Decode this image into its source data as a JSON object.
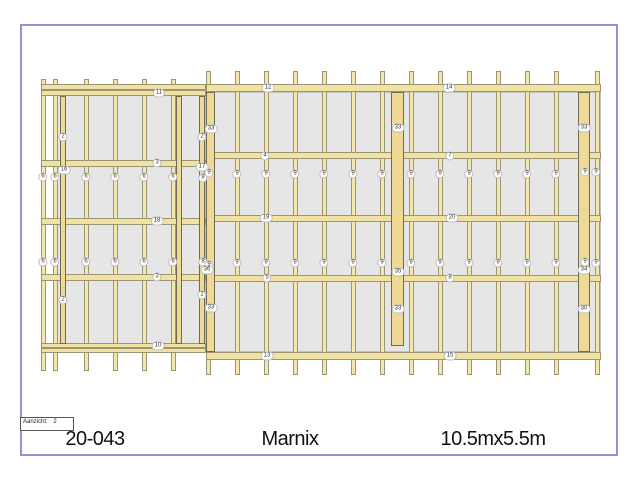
{
  "sheet": {
    "x": 20,
    "y": 24,
    "w": 598,
    "h": 432,
    "border_color": "#9193ce"
  },
  "titleblock": {
    "code": "20-043",
    "name": "Marnix",
    "size": "10.5mx5.5m"
  },
  "viewbox": {
    "label": "Aanzicht:",
    "value": "2"
  },
  "colors": {
    "wood": "#f4e7ae",
    "rail": "#f2e2a2",
    "post": "#eeda96",
    "wood_border": "#9b9577",
    "post_border": "#6f6a55",
    "panel": "#e6e6e6",
    "panel_border": "#c3c3c3",
    "sheet_border": "#9193ce",
    "label_text": "#333333"
  },
  "drawing": {
    "panels": [
      {
        "x": 57,
        "y": 92,
        "w": 149,
        "h": 252
      },
      {
        "x": 206,
        "y": 92,
        "w": 395,
        "h": 260
      }
    ],
    "studs": [
      {
        "x": 41,
        "y1": 79,
        "y2": 371
      },
      {
        "x": 53,
        "y1": 79,
        "y2": 371
      },
      {
        "x": 84,
        "y1": 79,
        "y2": 371
      },
      {
        "x": 113,
        "y1": 79,
        "y2": 371
      },
      {
        "x": 142,
        "y1": 79,
        "y2": 371
      },
      {
        "x": 171,
        "y1": 79,
        "y2": 371
      },
      {
        "x": 206,
        "y1": 71,
        "y2": 375
      },
      {
        "x": 235,
        "y1": 71,
        "y2": 375
      },
      {
        "x": 264,
        "y1": 71,
        "y2": 375
      },
      {
        "x": 293,
        "y1": 71,
        "y2": 375
      },
      {
        "x": 322,
        "y1": 71,
        "y2": 375
      },
      {
        "x": 351,
        "y1": 71,
        "y2": 375
      },
      {
        "x": 380,
        "y1": 71,
        "y2": 375
      },
      {
        "x": 409,
        "y1": 71,
        "y2": 375
      },
      {
        "x": 438,
        "y1": 71,
        "y2": 375
      },
      {
        "x": 467,
        "y1": 71,
        "y2": 375
      },
      {
        "x": 496,
        "y1": 71,
        "y2": 375
      },
      {
        "x": 525,
        "y1": 71,
        "y2": 375
      },
      {
        "x": 554,
        "y1": 71,
        "y2": 375
      },
      {
        "x": 595,
        "y1": 71,
        "y2": 375
      }
    ],
    "rails": [
      {
        "x1": 41,
        "x2": 206,
        "y": 84,
        "h": 6
      },
      {
        "x1": 41,
        "x2": 206,
        "y": 90,
        "h": 6
      },
      {
        "x1": 41,
        "x2": 206,
        "y": 160,
        "h": 7
      },
      {
        "x1": 41,
        "x2": 206,
        "y": 218,
        "h": 7
      },
      {
        "x1": 41,
        "x2": 206,
        "y": 274,
        "h": 7
      },
      {
        "x1": 41,
        "x2": 206,
        "y": 343,
        "h": 5
      },
      {
        "x1": 41,
        "x2": 206,
        "y": 348,
        "h": 5
      },
      {
        "x1": 206,
        "x2": 601,
        "y": 84,
        "h": 8
      },
      {
        "x1": 206,
        "x2": 601,
        "y": 152,
        "h": 7
      },
      {
        "x1": 206,
        "x2": 601,
        "y": 215,
        "h": 7
      },
      {
        "x1": 206,
        "x2": 601,
        "y": 275,
        "h": 7
      },
      {
        "x1": 206,
        "x2": 601,
        "y": 352,
        "h": 8
      }
    ],
    "posts": [
      {
        "x": 60,
        "y": 96,
        "w": 6,
        "h": 248
      },
      {
        "x": 176,
        "y": 96,
        "w": 6,
        "h": 248
      },
      {
        "x": 199,
        "y": 96,
        "w": 6,
        "h": 248
      },
      {
        "x": 206,
        "y": 92,
        "w": 9,
        "h": 260
      },
      {
        "x": 391,
        "y": 92,
        "w": 13,
        "h": 254
      },
      {
        "x": 578,
        "y": 92,
        "w": 12,
        "h": 260
      }
    ],
    "labels": [
      {
        "x": 159,
        "y": 93,
        "t": "11"
      },
      {
        "x": 268,
        "y": 88,
        "t": "12"
      },
      {
        "x": 449,
        "y": 88,
        "t": "14"
      },
      {
        "x": 157,
        "y": 163,
        "t": "3"
      },
      {
        "x": 157,
        "y": 221,
        "t": "18"
      },
      {
        "x": 157,
        "y": 277,
        "t": "3"
      },
      {
        "x": 158,
        "y": 346,
        "t": "10"
      },
      {
        "x": 265,
        "y": 156,
        "t": "4"
      },
      {
        "x": 450,
        "y": 156,
        "t": "7"
      },
      {
        "x": 266,
        "y": 218,
        "t": "19"
      },
      {
        "x": 452,
        "y": 218,
        "t": "20"
      },
      {
        "x": 267,
        "y": 278,
        "t": "5"
      },
      {
        "x": 450,
        "y": 278,
        "t": "8"
      },
      {
        "x": 267,
        "y": 356,
        "t": "13"
      },
      {
        "x": 450,
        "y": 356,
        "t": "15"
      },
      {
        "x": 43,
        "y": 177,
        "t": "6"
      },
      {
        "x": 55,
        "y": 177,
        "t": "6"
      },
      {
        "x": 86,
        "y": 177,
        "t": "6"
      },
      {
        "x": 115,
        "y": 177,
        "t": "6"
      },
      {
        "x": 144,
        "y": 177,
        "t": "6"
      },
      {
        "x": 173,
        "y": 177,
        "t": "6"
      },
      {
        "x": 43,
        "y": 262,
        "t": "6"
      },
      {
        "x": 55,
        "y": 262,
        "t": "6"
      },
      {
        "x": 86,
        "y": 262,
        "t": "6"
      },
      {
        "x": 115,
        "y": 262,
        "t": "6"
      },
      {
        "x": 144,
        "y": 262,
        "t": "6"
      },
      {
        "x": 173,
        "y": 262,
        "t": "6"
      },
      {
        "x": 63,
        "y": 137,
        "t": "2"
      },
      {
        "x": 64,
        "y": 170,
        "t": "16"
      },
      {
        "x": 63,
        "y": 300,
        "t": "2"
      },
      {
        "x": 202,
        "y": 137,
        "t": "2"
      },
      {
        "x": 211,
        "y": 129,
        "t": "33"
      },
      {
        "x": 202,
        "y": 167,
        "t": "17"
      },
      {
        "x": 209,
        "y": 173,
        "t": "9"
      },
      {
        "x": 203,
        "y": 178,
        "t": "8"
      },
      {
        "x": 203,
        "y": 262,
        "t": "8"
      },
      {
        "x": 209,
        "y": 265,
        "t": "9"
      },
      {
        "x": 207,
        "y": 270,
        "t": "36"
      },
      {
        "x": 202,
        "y": 295,
        "t": "2"
      },
      {
        "x": 211,
        "y": 308,
        "t": "33"
      },
      {
        "x": 237,
        "y": 174,
        "t": "9"
      },
      {
        "x": 266,
        "y": 174,
        "t": "9"
      },
      {
        "x": 295,
        "y": 174,
        "t": "9"
      },
      {
        "x": 324,
        "y": 174,
        "t": "9"
      },
      {
        "x": 353,
        "y": 174,
        "t": "9"
      },
      {
        "x": 382,
        "y": 174,
        "t": "9"
      },
      {
        "x": 411,
        "y": 174,
        "t": "9"
      },
      {
        "x": 440,
        "y": 174,
        "t": "9"
      },
      {
        "x": 469,
        "y": 174,
        "t": "9"
      },
      {
        "x": 498,
        "y": 174,
        "t": "9"
      },
      {
        "x": 527,
        "y": 174,
        "t": "9"
      },
      {
        "x": 556,
        "y": 174,
        "t": "9"
      },
      {
        "x": 585,
        "y": 172,
        "t": "9"
      },
      {
        "x": 596,
        "y": 172,
        "t": "9"
      },
      {
        "x": 237,
        "y": 263,
        "t": "9"
      },
      {
        "x": 266,
        "y": 263,
        "t": "9"
      },
      {
        "x": 295,
        "y": 263,
        "t": "9"
      },
      {
        "x": 324,
        "y": 263,
        "t": "9"
      },
      {
        "x": 353,
        "y": 263,
        "t": "9"
      },
      {
        "x": 382,
        "y": 263,
        "t": "9"
      },
      {
        "x": 411,
        "y": 263,
        "t": "9"
      },
      {
        "x": 440,
        "y": 263,
        "t": "9"
      },
      {
        "x": 469,
        "y": 263,
        "t": "9"
      },
      {
        "x": 498,
        "y": 263,
        "t": "9"
      },
      {
        "x": 527,
        "y": 263,
        "t": "9"
      },
      {
        "x": 556,
        "y": 263,
        "t": "9"
      },
      {
        "x": 585,
        "y": 262,
        "t": "9"
      },
      {
        "x": 596,
        "y": 263,
        "t": "9"
      },
      {
        "x": 398,
        "y": 128,
        "t": "33"
      },
      {
        "x": 398,
        "y": 272,
        "t": "35"
      },
      {
        "x": 398,
        "y": 309,
        "t": "33"
      },
      {
        "x": 584,
        "y": 128,
        "t": "33"
      },
      {
        "x": 584,
        "y": 270,
        "t": "34"
      },
      {
        "x": 584,
        "y": 309,
        "t": "30"
      }
    ]
  }
}
